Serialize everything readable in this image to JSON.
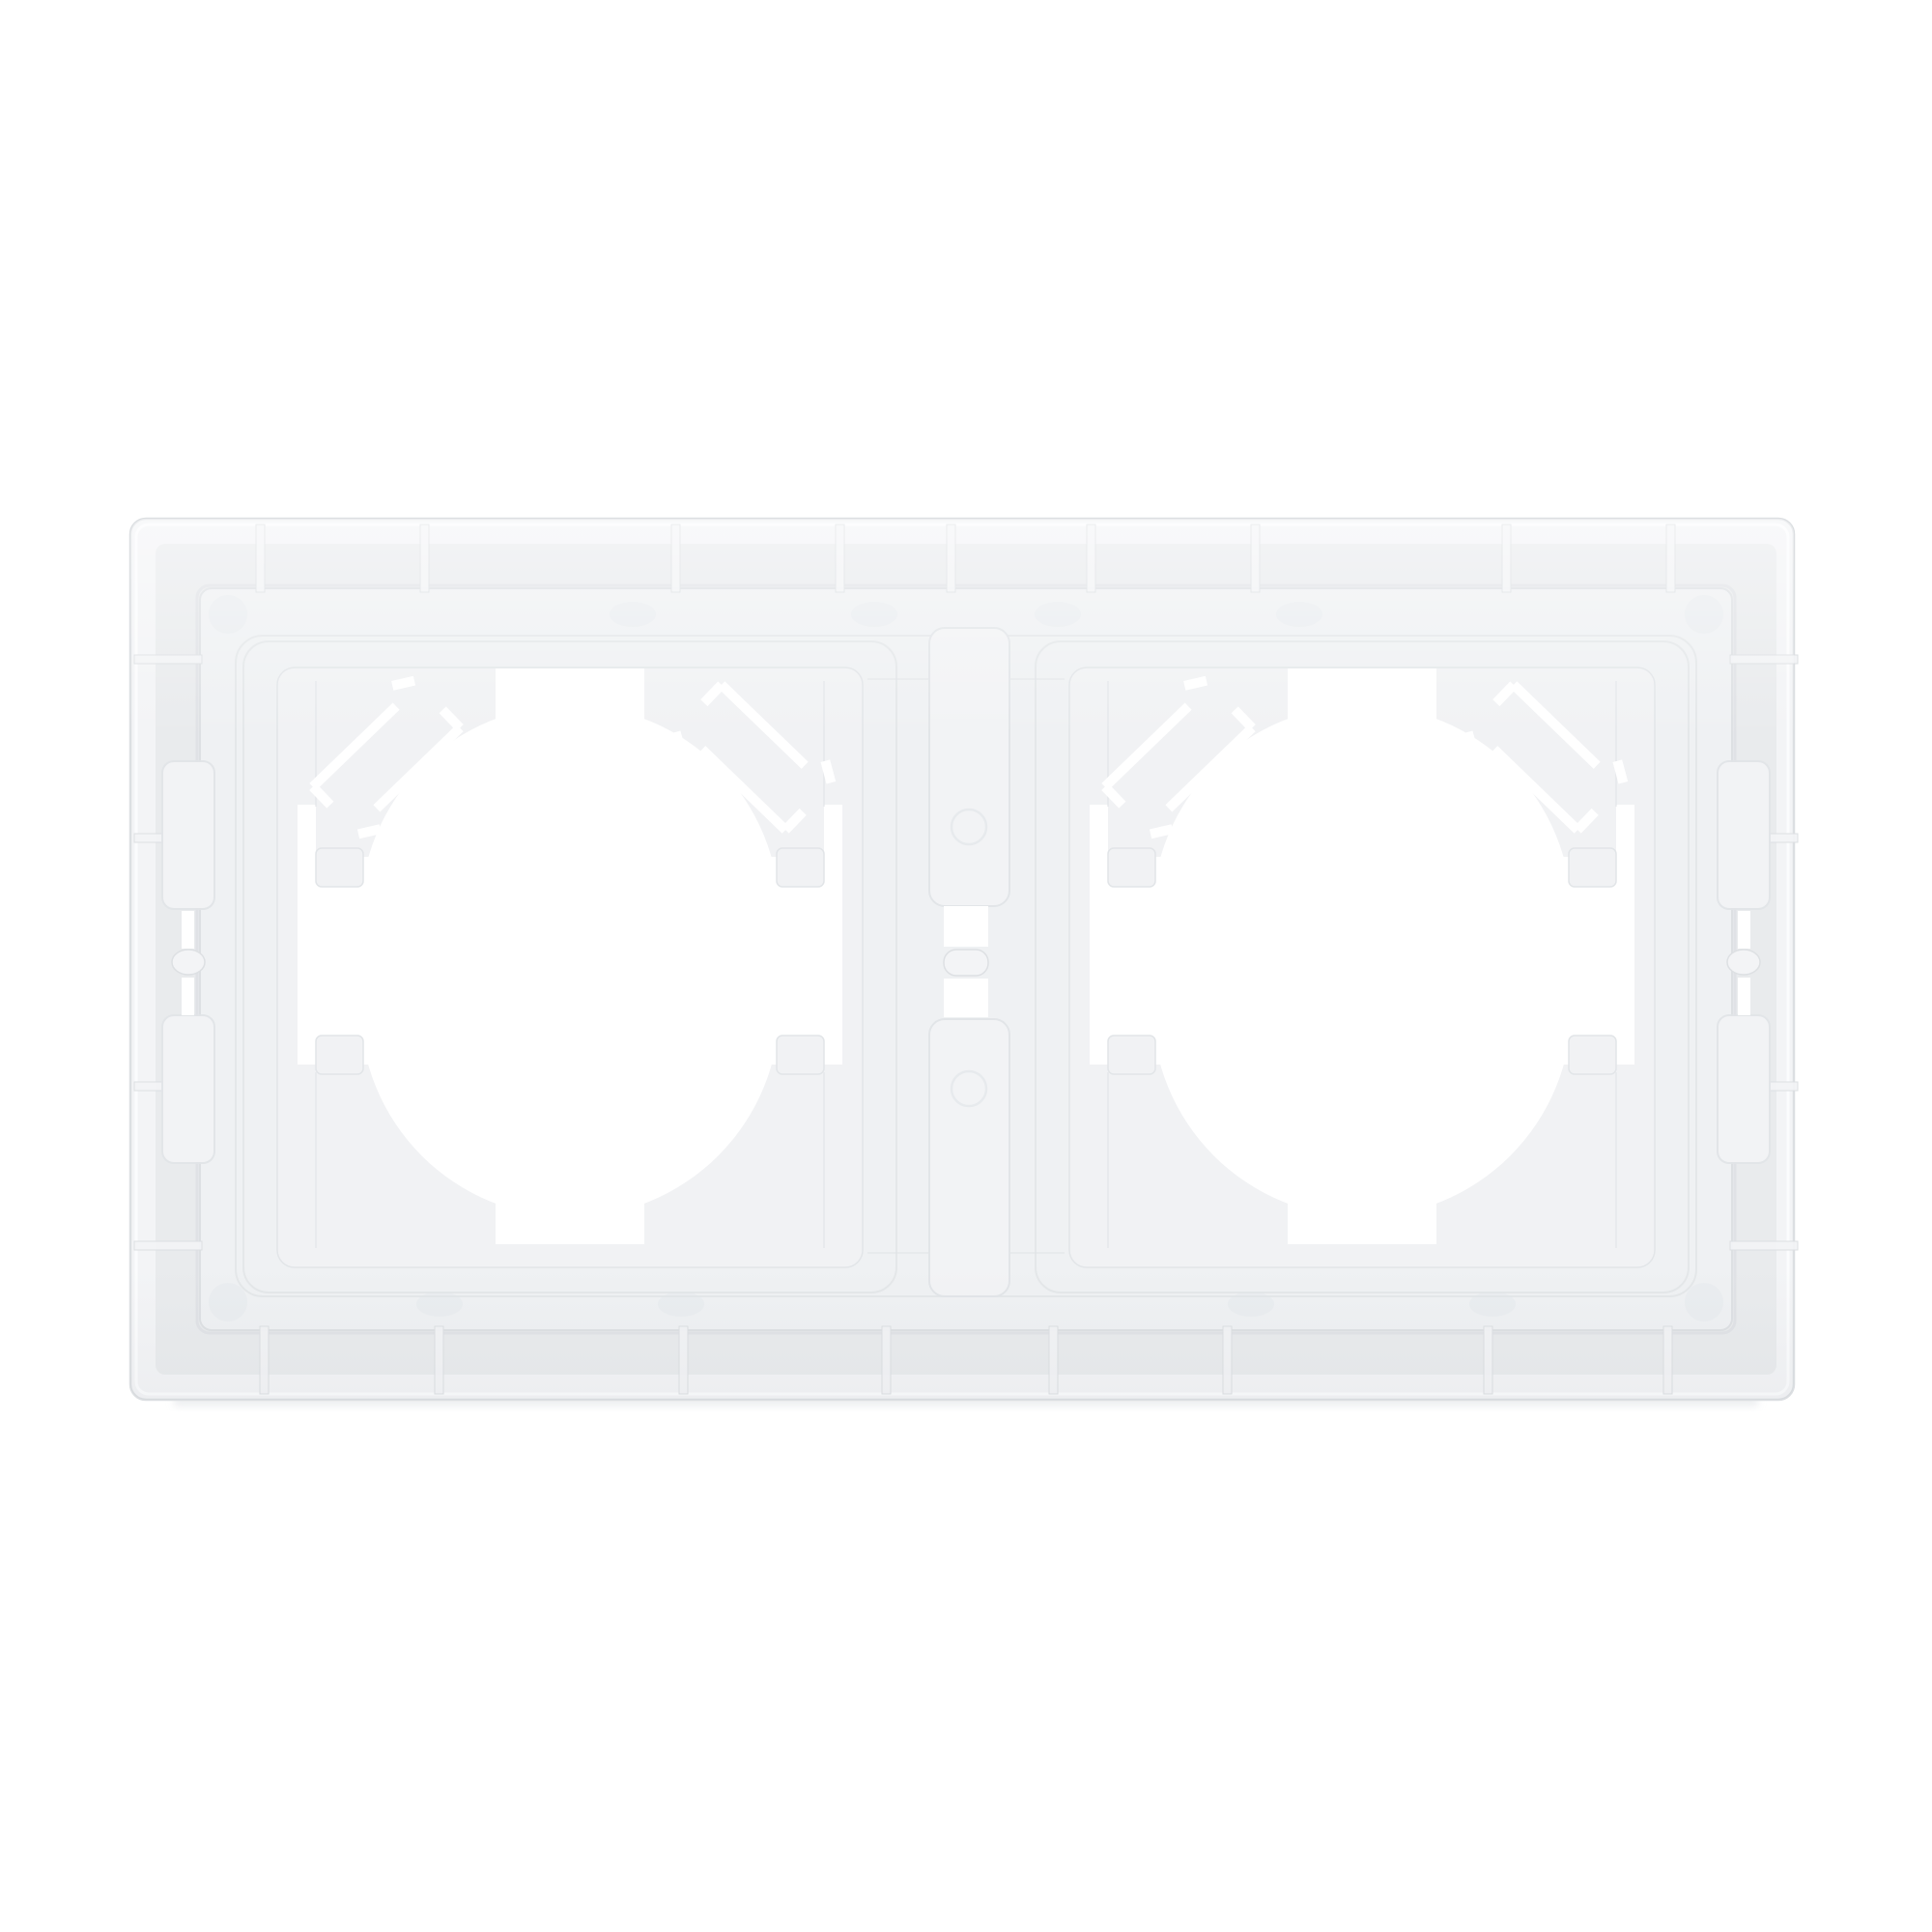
{
  "meta": {
    "domain": "Natural-Image",
    "subject": "Rear view of a white plastic two-gang wall socket / switch frame on a white background"
  },
  "colors": {
    "background": "#ffffff",
    "rim_face": "#f3f4f6",
    "rim_edge": "#dcdfe2",
    "rim_highlight": "#fbfcfd",
    "channel": "#e9ebed",
    "channel_shadow": "#dde0e3",
    "plate": "#eff1f3",
    "plate_line": "#e2e5e8",
    "module_plate": "#f1f2f4",
    "tongue": "#f3f4f6",
    "cutout": "#ffffff",
    "mark": "#e6e9ec",
    "shadow": "#dfe2e6"
  },
  "product": {
    "modules_count": 2,
    "parts": [
      "outer-frame",
      "mounting-channel",
      "back-plate",
      "socket-module-left",
      "socket-module-right",
      "center-bridge",
      "side-latch-left",
      "side-latch-right"
    ]
  }
}
